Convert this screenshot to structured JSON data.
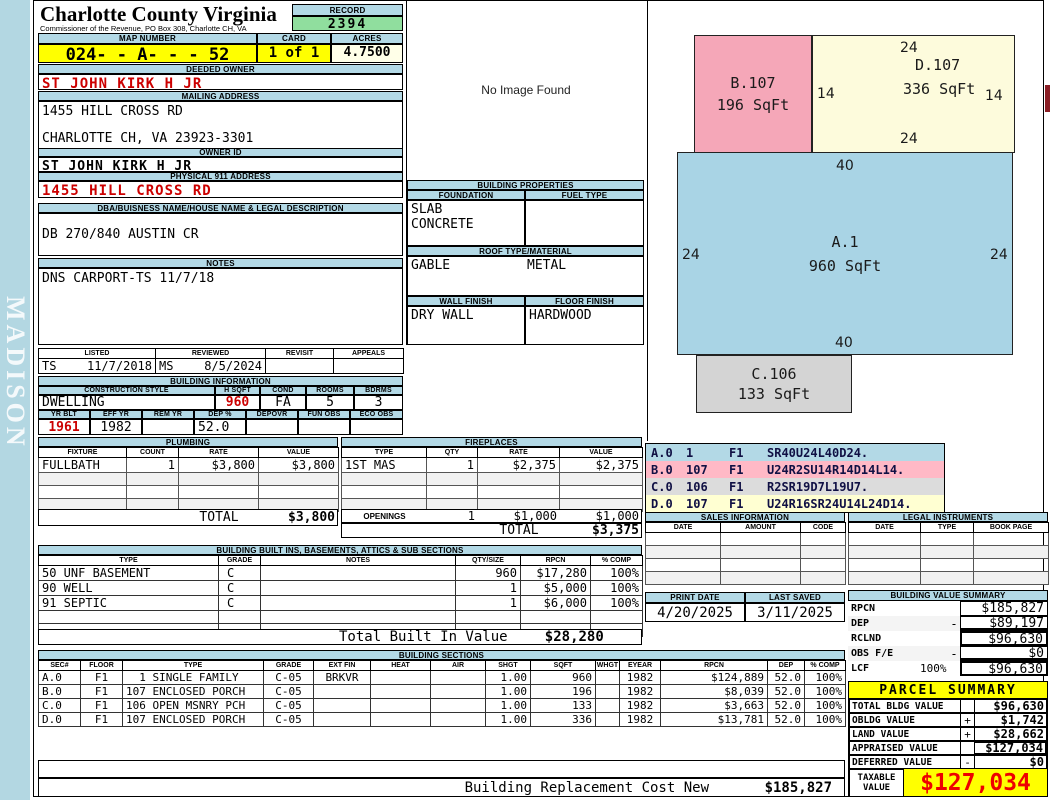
{
  "watermark": "MADISON",
  "header": {
    "county": "Charlotte County Virginia",
    "commissioner": "Commissioner of the Revenue, PO Box 308, Charlotte CH, VA",
    "record_label": "RECORD",
    "record_value": "2394",
    "map_number_label": "MAP NUMBER",
    "map_number": "024- - A- - - 52",
    "card_label": "CARD",
    "card_value": "1 of 1",
    "acres_label": "ACRES",
    "acres_value": "4.7500"
  },
  "owner": {
    "deeded_owner_label": "DEEDED OWNER",
    "deeded_owner": "ST JOHN KIRK H JR",
    "mailing_address_label": "MAILING ADDRESS",
    "mailing_address_line1": "1455 HILL CROSS RD",
    "mailing_address_line2": "CHARLOTTE CH, VA 23923-3301",
    "owner_id_label": "OWNER ID",
    "owner_id": "ST JOHN KIRK H JR",
    "physical_address_label": "PHYSICAL 911 ADDRESS",
    "physical_address": "1455 HILL CROSS RD",
    "dba_label": "DBA/BUISNESS NAME/HOUSE NAME & LEGAL DESCRIPTION",
    "dba": "DB 270/840 AUSTIN CR",
    "notes_label": "NOTES",
    "notes": "DNS CARPORT-TS 11/7/18"
  },
  "visits": {
    "listed_label": "LISTED",
    "reviewed_label": "REVIEWED",
    "revisit_label": "REVISIT",
    "appeals_label": "APPEALS",
    "listed_by": "TS",
    "listed_date": "11/7/2018",
    "reviewed_by": "MS",
    "reviewed_date": "8/5/2024",
    "revisit": "",
    "appeals": ""
  },
  "building_info": {
    "title": "BUILDING INFORMATION",
    "style_label": "CONSTRUCTION STYLE",
    "hsqft_label": "H SQFT",
    "cond_label": "COND",
    "rooms_label": "ROOMS",
    "bdrms_label": "BDRMS",
    "construction_style": "DWELLING",
    "hsqft": "960",
    "cond": "FA",
    "rooms": "5",
    "bdrms": "3",
    "yrblt_label": "YR BLT",
    "effyr_label": "EFF YR",
    "remyr_label": "REM YR",
    "dep_label": "DEP %",
    "depovr_label": "DEPOVR",
    "funobs_label": "FUN OBS",
    "ecoobs_label": "ECO OBS",
    "yr_blt": "1961",
    "eff_yr": "1982",
    "rem_yr": "",
    "dep_pct": "52.0",
    "depovr": "",
    "fun_obs": "",
    "eco_obs": ""
  },
  "plumbing": {
    "title": "PLUMBING",
    "headers": [
      "FIXTURE",
      "COUNT",
      "RATE",
      "VALUE"
    ],
    "rows": [
      [
        "FULLBATH",
        "1",
        "$3,800",
        "$3,800"
      ],
      [
        "",
        "",
        "",
        ""
      ],
      [
        "",
        "",
        "",
        ""
      ],
      [
        "",
        "",
        "",
        ""
      ]
    ],
    "total_label": "TOTAL",
    "total": "$3,800"
  },
  "fireplaces": {
    "title": "FIREPLACES",
    "headers": [
      "TYPE",
      "QTY",
      "RATE",
      "VALUE"
    ],
    "rows": [
      [
        "1ST MAS",
        "1",
        "$2,375",
        "$2,375"
      ],
      [
        "",
        "",
        "",
        ""
      ],
      [
        "",
        "",
        "",
        ""
      ],
      [
        "",
        "",
        "",
        ""
      ]
    ],
    "openings_label": "OPENINGS",
    "openings_qty": "1",
    "openings_rate": "$1,000",
    "openings_value": "$1,000",
    "total_label": "TOTAL",
    "total": "$3,375"
  },
  "built_ins": {
    "title": "BUILDING BUILT INS, BASEMENTS, ATTICS & SUB SECTIONS",
    "headers": [
      "TYPE",
      "GRADE",
      "NOTES",
      "QTY/SIZE",
      "RPCN",
      "% COMP"
    ],
    "rows": [
      [
        "50 UNF BASEMENT",
        "C",
        "",
        "960",
        "$17,280",
        "100%"
      ],
      [
        "90 WELL",
        "C",
        "",
        "1",
        "$5,000",
        "100%"
      ],
      [
        "91 SEPTIC",
        "C",
        "",
        "1",
        "$6,000",
        "100%"
      ],
      [
        "",
        "",
        "",
        "",
        "",
        ""
      ],
      [
        "",
        "",
        "",
        "",
        "",
        ""
      ]
    ],
    "total_label": "Total Built In Value",
    "total": "$28,280"
  },
  "building_sections": {
    "title": "BUILDING SECTIONS",
    "headers": [
      "SEC#",
      "FLOOR",
      "TYPE",
      "GRADE",
      "EXT FIN",
      "HEAT",
      "AIR",
      "SHGT",
      "SQFT",
      "WHGT",
      "EYEAR",
      "RPCN",
      "DEP",
      "% COMP"
    ],
    "rows": [
      [
        "A.0",
        "F1",
        "  1 SINGLE FAMILY",
        "C-05",
        "BRKVR",
        "",
        "",
        "1.00",
        "960",
        "",
        "1982",
        "$124,889",
        "52.0",
        "100%"
      ],
      [
        "B.0",
        "F1",
        "107 ENCLOSED PORCH",
        "C-05",
        "",
        "",
        "",
        "1.00",
        "196",
        "",
        "1982",
        "$8,039",
        "52.0",
        "100%"
      ],
      [
        "C.0",
        "F1",
        "106 OPEN MSNRY PCH",
        "C-05",
        "",
        "",
        "",
        "1.00",
        "133",
        "",
        "1982",
        "$3,663",
        "52.0",
        "100%"
      ],
      [
        "D.0",
        "F1",
        "107 ENCLOSED PORCH",
        "C-05",
        "",
        "",
        "",
        "1.00",
        "336",
        "",
        "1982",
        "$13,781",
        "52.0",
        "100%"
      ]
    ]
  },
  "replacement_cost": {
    "label": "Building Replacement Cost New",
    "value": "$185,827"
  },
  "image_panel": {
    "message": "No Image Found"
  },
  "building_properties": {
    "title": "BUILDING PROPERTIES",
    "foundation_label": "FOUNDATION",
    "fuel_type_label": "FUEL TYPE",
    "foundation_line1": "SLAB",
    "foundation_line2": "CONCRETE",
    "fuel_type": "",
    "roof_label": "ROOF TYPE/MATERIAL",
    "roof_type": "GABLE",
    "roof_material": "METAL",
    "wall_finish_label": "WALL FINISH",
    "floor_finish_label": "FLOOR FINISH",
    "wall_finish": "DRY WALL",
    "floor_finish": "HARDWOOD"
  },
  "sketch": {
    "a": {
      "label": "A.1",
      "sqft": "960 SqFt",
      "top": "40",
      "left": "24",
      "right": "24",
      "bottom": "40"
    },
    "b": {
      "label": "B.107",
      "sqft": "196 SqFt"
    },
    "c": {
      "label": "C.106",
      "sqft": "133 SqFt"
    },
    "d": {
      "label": "D.107",
      "sqft": "336 SqFt",
      "top": "24",
      "left": "14",
      "right": "14",
      "bottom": "24"
    }
  },
  "sketch_codes": {
    "rows": [
      {
        "sec": "A.0",
        "code_num": "1",
        "floor": "F1",
        "vector": "SR40U24L40D24."
      },
      {
        "sec": "B.0",
        "code_num": "107",
        "floor": "F1",
        "vector": "U24R2SU14R14D14L14."
      },
      {
        "sec": "C.0",
        "code_num": "106",
        "floor": "F1",
        "vector": "R2SR19D7L19U7."
      },
      {
        "sec": "D.0",
        "code_num": "107",
        "floor": "F1",
        "vector": "U24R16SR24U14L24D14."
      }
    ]
  },
  "sales_information": {
    "title": "SALES INFORMATION",
    "headers": [
      "DATE",
      "AMOUNT",
      "CODE"
    ],
    "rows": [
      [
        "",
        "",
        ""
      ],
      [
        "",
        "",
        ""
      ],
      [
        "",
        "",
        ""
      ],
      [
        "",
        "",
        ""
      ]
    ]
  },
  "legal_instruments": {
    "title": "LEGAL INSTRUMENTS",
    "headers": [
      "DATE",
      "TYPE",
      "BOOK PAGE"
    ],
    "rows": [
      [
        "",
        "",
        ""
      ],
      [
        "",
        "",
        ""
      ],
      [
        "",
        "",
        ""
      ],
      [
        "",
        "",
        ""
      ]
    ]
  },
  "dates": {
    "print_date_label": "PRINT DATE",
    "print_date": "4/20/2025",
    "last_saved_label": "LAST SAVED",
    "last_saved": "3/11/2025"
  },
  "building_value_summary": {
    "title": "BUILDING VALUE SUMMARY",
    "rows": [
      {
        "label": "RPCN",
        "pct": "",
        "op": "",
        "value": "$185,827"
      },
      {
        "label": "DEP",
        "pct": "",
        "op": "-",
        "value": "$89,197"
      },
      {
        "label": "RCLND",
        "pct": "",
        "op": "",
        "value": "$96,630"
      },
      {
        "label": "OBS F/E",
        "pct": "",
        "op": "-",
        "value": "$0"
      },
      {
        "label": "LCF",
        "pct": "100%",
        "op": "",
        "value": "$96,630"
      }
    ]
  },
  "parcel_summary": {
    "title": "PARCEL SUMMARY",
    "rows": [
      {
        "label": "TOTAL BLDG VALUE",
        "op": "",
        "value": "$96,630"
      },
      {
        "label": "OBLDG VALUE",
        "op": "+",
        "value": "$1,742"
      },
      {
        "label": "LAND VALUE",
        "op": "+",
        "value": "$28,662"
      },
      {
        "label": "APPRAISED VALUE",
        "op": "",
        "value": "$127,034"
      },
      {
        "label": "DEFERRED VALUE",
        "op": "-",
        "value": "$0"
      }
    ],
    "taxable_label": "TAXABLE VALUE",
    "taxable_value": "$127,034"
  },
  "colors": {
    "section_header_blue": "#b3d9e6",
    "sidebar_blue": "#b3d7e2",
    "record_green": "#90de9e",
    "highlight_yellow": "#ffff00",
    "acres_ivory": "#ffffe8",
    "alert_red": "#cc0000",
    "taxable_red": "#ee0000",
    "sketch_blue": "#a9d4e5",
    "sketch_pink": "#f5a7b8",
    "sketch_yellow": "#fdfbdc",
    "sketch_gray": "#d4d4d4",
    "edge_marker_maroon": "#8b1f26"
  }
}
